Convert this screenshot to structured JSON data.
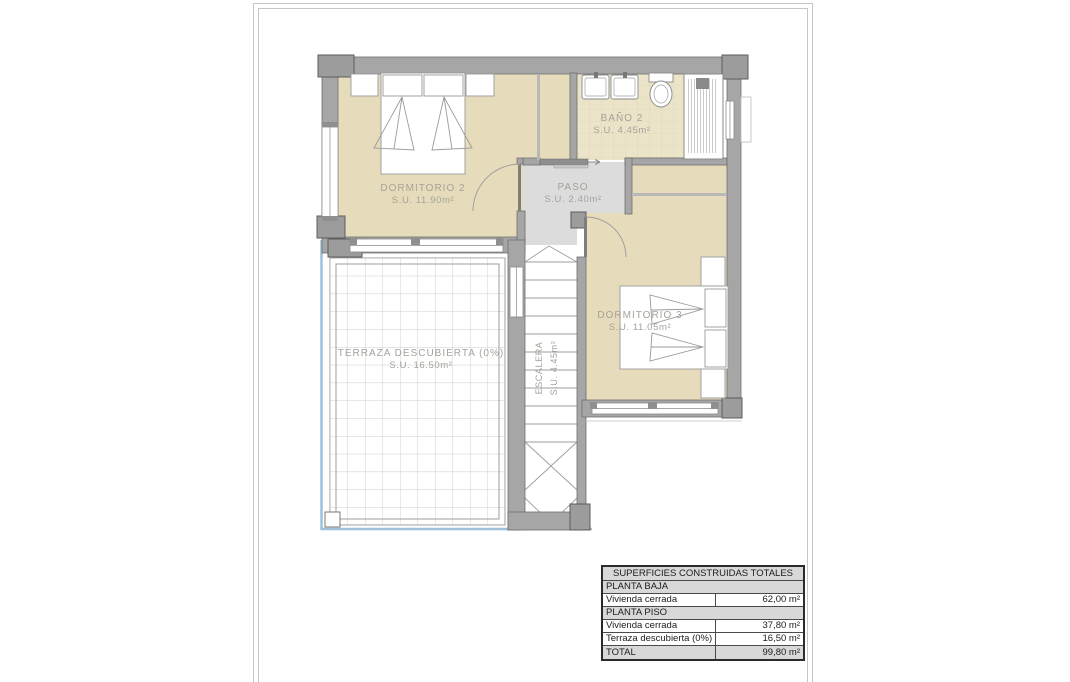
{
  "floor_plan": {
    "rooms": [
      {
        "id": "dormitorio-2",
        "name": "DORMITORIO 2",
        "area": "S.U. 11.90m²"
      },
      {
        "id": "bano-2",
        "name": "BAÑO 2",
        "area": "S.U. 4.45m²"
      },
      {
        "id": "paso",
        "name": "PASO",
        "area": "S.U. 2.40m²"
      },
      {
        "id": "dormitorio-3",
        "name": "DORMITORIO 3",
        "area": "S.U. 11.05m²"
      },
      {
        "id": "escalera",
        "name": "ESCALERA",
        "area": "S.U. 4.45m²"
      },
      {
        "id": "terraza",
        "name": "TERRAZA DESCUBIERTA (0%)",
        "area": "S.U. 16.50m²"
      }
    ],
    "colors": {
      "wall": "#a6a6a6",
      "pillar": "#9c9c9c",
      "room_floor": "#e6dcbb",
      "bath_floor": "#ece4c9",
      "paso_floor": "#dcdcdc",
      "terrace_edge_blue": "#9fc0da",
      "label_text": "#a5a29a",
      "table_header_bg": "#d8d8d8"
    }
  },
  "table": {
    "title": "SUPERFICIES CONSTRUIDAS TOTALES",
    "sections": [
      {
        "header": "PLANTA BAJA",
        "rows": [
          {
            "label": "Vivienda cerrada",
            "value": "62,00 m²"
          }
        ]
      },
      {
        "header": "PLANTA PISO",
        "rows": [
          {
            "label": "Vivienda cerrada",
            "value": "37,80 m²"
          },
          {
            "label": "Terraza descubierta (0%)",
            "value": "16,50 m²"
          }
        ]
      }
    ],
    "total": {
      "label": "TOTAL",
      "value": "99,80 m²"
    }
  }
}
